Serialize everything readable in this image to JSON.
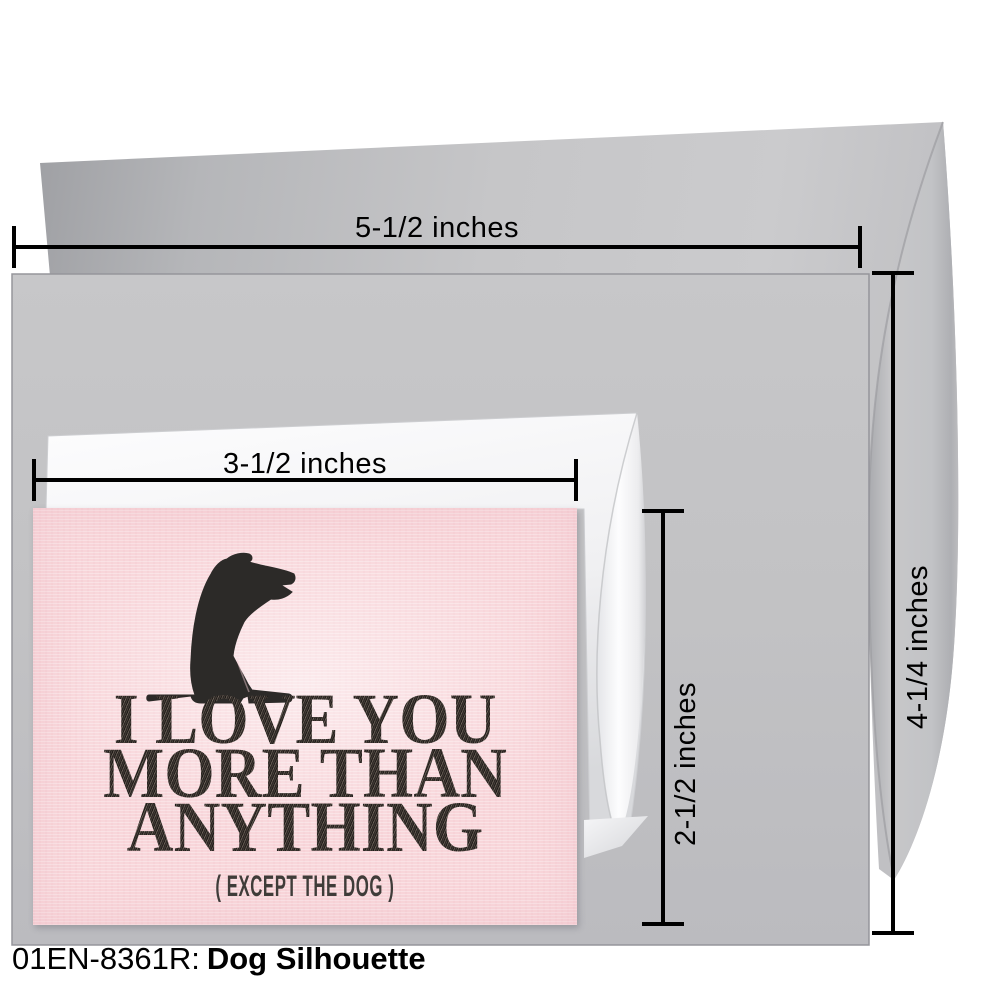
{
  "measurements": {
    "large_envelope_width": "5-1/2 inches",
    "large_envelope_height": "4-1/4 inches",
    "small_envelope_width": "3-1/2 inches",
    "small_envelope_height": "2-1/2 inches"
  },
  "card": {
    "line1": "I LOVE YOU",
    "line2": "MORE THAN",
    "line3": "ANYTHING",
    "tagline": "( EXCEPT THE DOG )",
    "background_color": "#f8d6da",
    "ink_color": "#2b2623",
    "artwork": "dog-silhouette"
  },
  "caption": {
    "code": "01EN-8361R:",
    "title": "Dog Silhouette"
  },
  "colors": {
    "large_envelope_gray": "#c3c3c6",
    "large_envelope_flap_shade": "#9fa0a4",
    "small_envelope_white": "#f4f4f6",
    "dimension_line": "#000000",
    "background": "#ffffff"
  }
}
